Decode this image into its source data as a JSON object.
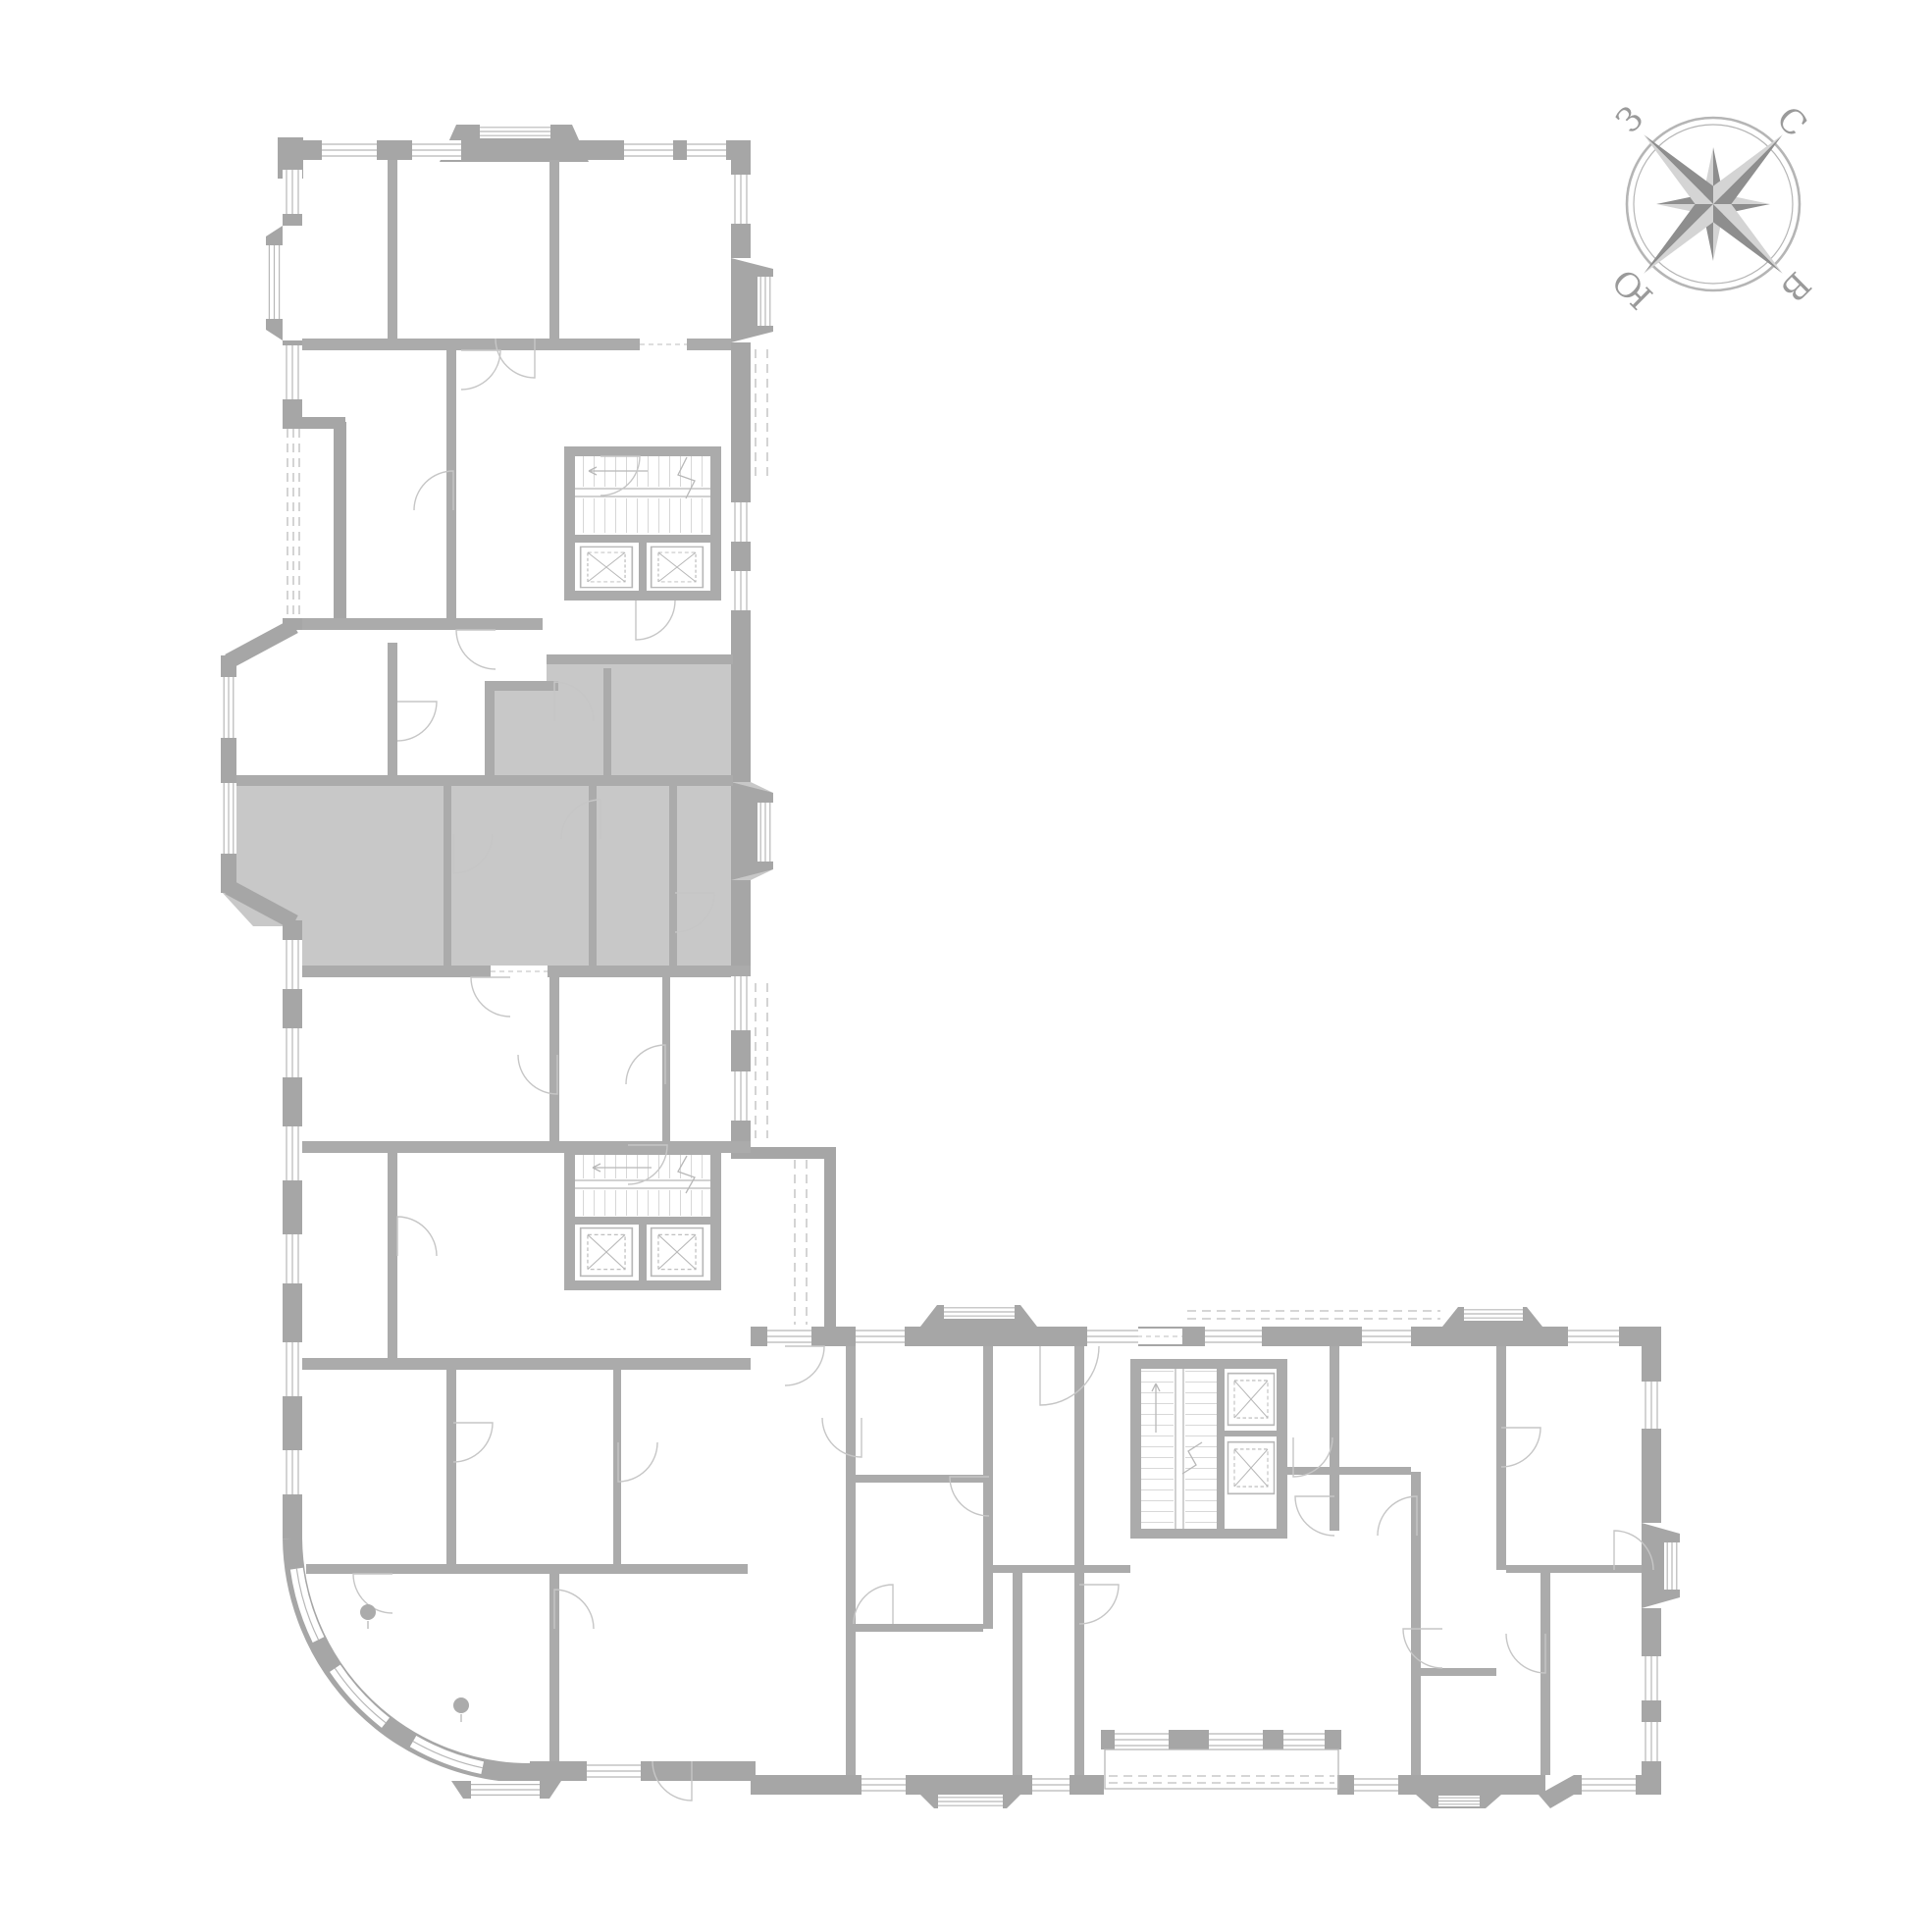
{
  "compass": {
    "north": "С",
    "east": "В",
    "south": "Ю",
    "west": "З"
  },
  "colors": {
    "background": "#ffffff",
    "walls": "#a6a6a6",
    "partitions": "#ababab",
    "lines": "#c6c6c6",
    "window_lines": "#b8b8b8",
    "dashed_lines": "#c9c9c9",
    "highlight": "#c8c8c8",
    "compass_dark": "#8e8e8e",
    "compass_light": "#d4d4d4",
    "compass_ring": "#b5b5b5",
    "compass_labels": "#9a9a9a"
  },
  "plan": {
    "type": "residential floor plan, L-shaped building",
    "selected_apartment": {
      "highlighted": true,
      "fill": "#c8c8c8"
    },
    "stair_cores": 3,
    "elevators": 6,
    "columns": 2
  }
}
